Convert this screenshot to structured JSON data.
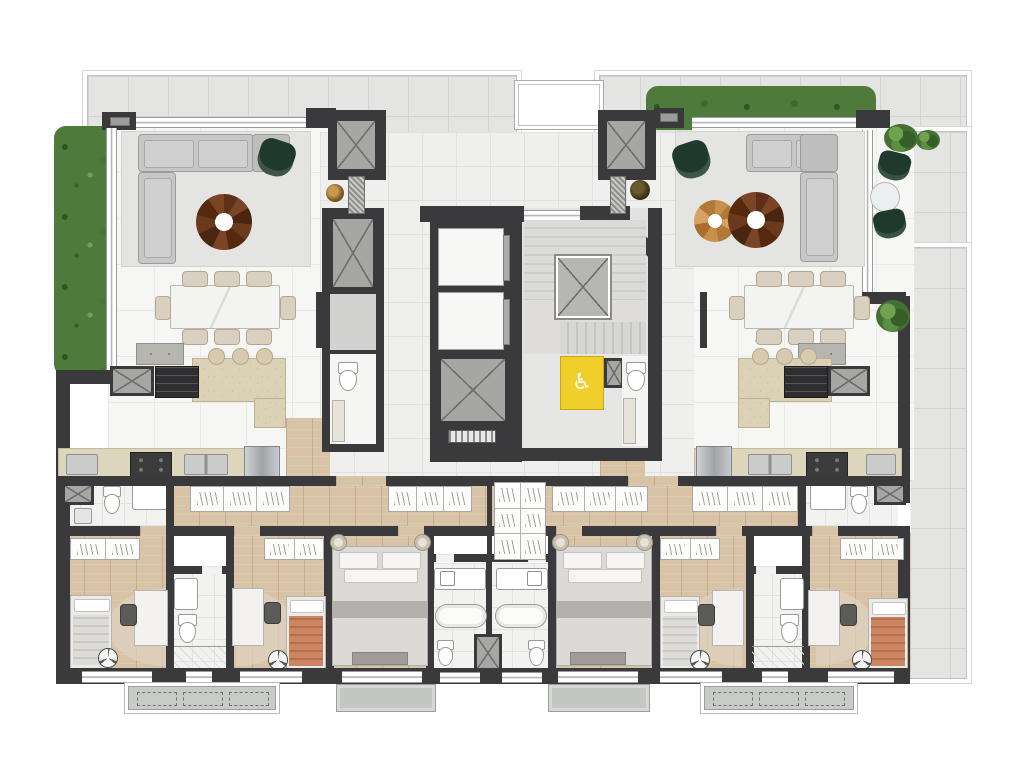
{
  "document": {
    "kind": "architectural floor plan rendering",
    "visible_text": [],
    "description_of_pixels": "Top-view rendered residential floor plan, two mirrored apartments around a central elevator/stair core, bedroom wing along the bottom, terraces with hedges on the left, top and right edges"
  },
  "icons": {
    "accessible": "♿"
  },
  "palette": {
    "wall": "#3a3a3c",
    "terrace": "#e4e5e3",
    "marble": "#f6f6f4",
    "wood": "#d8c3a6",
    "hedge": "#4e7a3c",
    "sofa": "#c6c7c6",
    "greenchair": "#1f3a2c",
    "island": "#dbd2b6",
    "counter": "#ded5bd",
    "accent": "#f0cf2b",
    "tableBrown": "#5d3017",
    "tableTan": "#c98f4c",
    "terracottaBed": "#c2714f",
    "balcony": "#c9cbc9"
  },
  "inventory": {
    "apartments": 2,
    "living_rooms": 2,
    "dining_tables": 2,
    "dining_chairs_per_table": 8,
    "kitchen_islands": 2,
    "island_stools_per_island": 3,
    "coffee_tables_per_living": 2,
    "green_armchairs": 2,
    "elevator_cabs_core": 2,
    "private_elevators": 2,
    "service_shafts_with_cross": "multiple",
    "scissor_stair": 1,
    "accessible_wc_highlighted_yellow": 1,
    "master_suites": 2,
    "small_bedrooms": 4,
    "single_beds": 4,
    "double_beds": 2,
    "bathrooms_center": 2,
    "small_bathrooms": 2,
    "laundry_areas": 2,
    "ceiling_fan_symbols": 4,
    "balconies": 4,
    "hedges": 2,
    "outdoor_green_chairs": 2,
    "outdoor_round_table": 1,
    "outdoor_bushes": 4
  }
}
